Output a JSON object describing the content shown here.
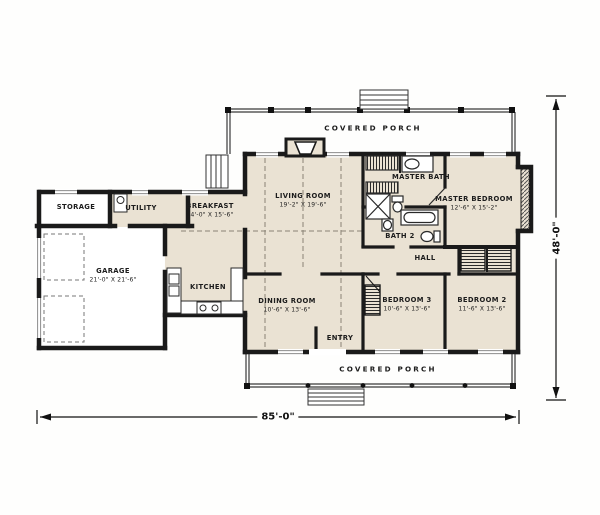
{
  "title": "House floor plan",
  "rooms": {
    "storage": {
      "name": "STORAGE"
    },
    "utility": {
      "name": "UTILITY"
    },
    "breakfast": {
      "name": "BREAKFAST",
      "dims": "14'-0\" X 15'-6\""
    },
    "living": {
      "name": "LIVING ROOM",
      "dims": "19'-2\" X 19'-6\""
    },
    "master_bath": {
      "name": "MASTER BATH"
    },
    "master_bedroom": {
      "name": "MASTER BEDROOM",
      "dims": "12'-6\" X 15'-2\""
    },
    "bath2": {
      "name": "BATH 2"
    },
    "hall": {
      "name": "HALL"
    },
    "garage": {
      "name": "GARAGE",
      "dims": "21'-0\" X 21'-6\""
    },
    "kitchen": {
      "name": "KITCHEN"
    },
    "dining": {
      "name": "DINING ROOM",
      "dims": "10'-6\" X 13'-6\""
    },
    "entry": {
      "name": "ENTRY"
    },
    "bedroom3": {
      "name": "BEDROOM 3",
      "dims": "10'-6\" X 13'-6\""
    },
    "bedroom2": {
      "name": "BEDROOM 2",
      "dims": "11'-6\" X 13'-6\""
    }
  },
  "porches": {
    "top": "COVERED PORCH",
    "bottom": "COVERED PORCH"
  },
  "overall_dimensions": {
    "width": "85'-0\"",
    "height": "48'-0\""
  },
  "colors": {
    "room_fill": "#eae2d3",
    "wall": "#1a1a1a",
    "background": "#fefefd"
  }
}
